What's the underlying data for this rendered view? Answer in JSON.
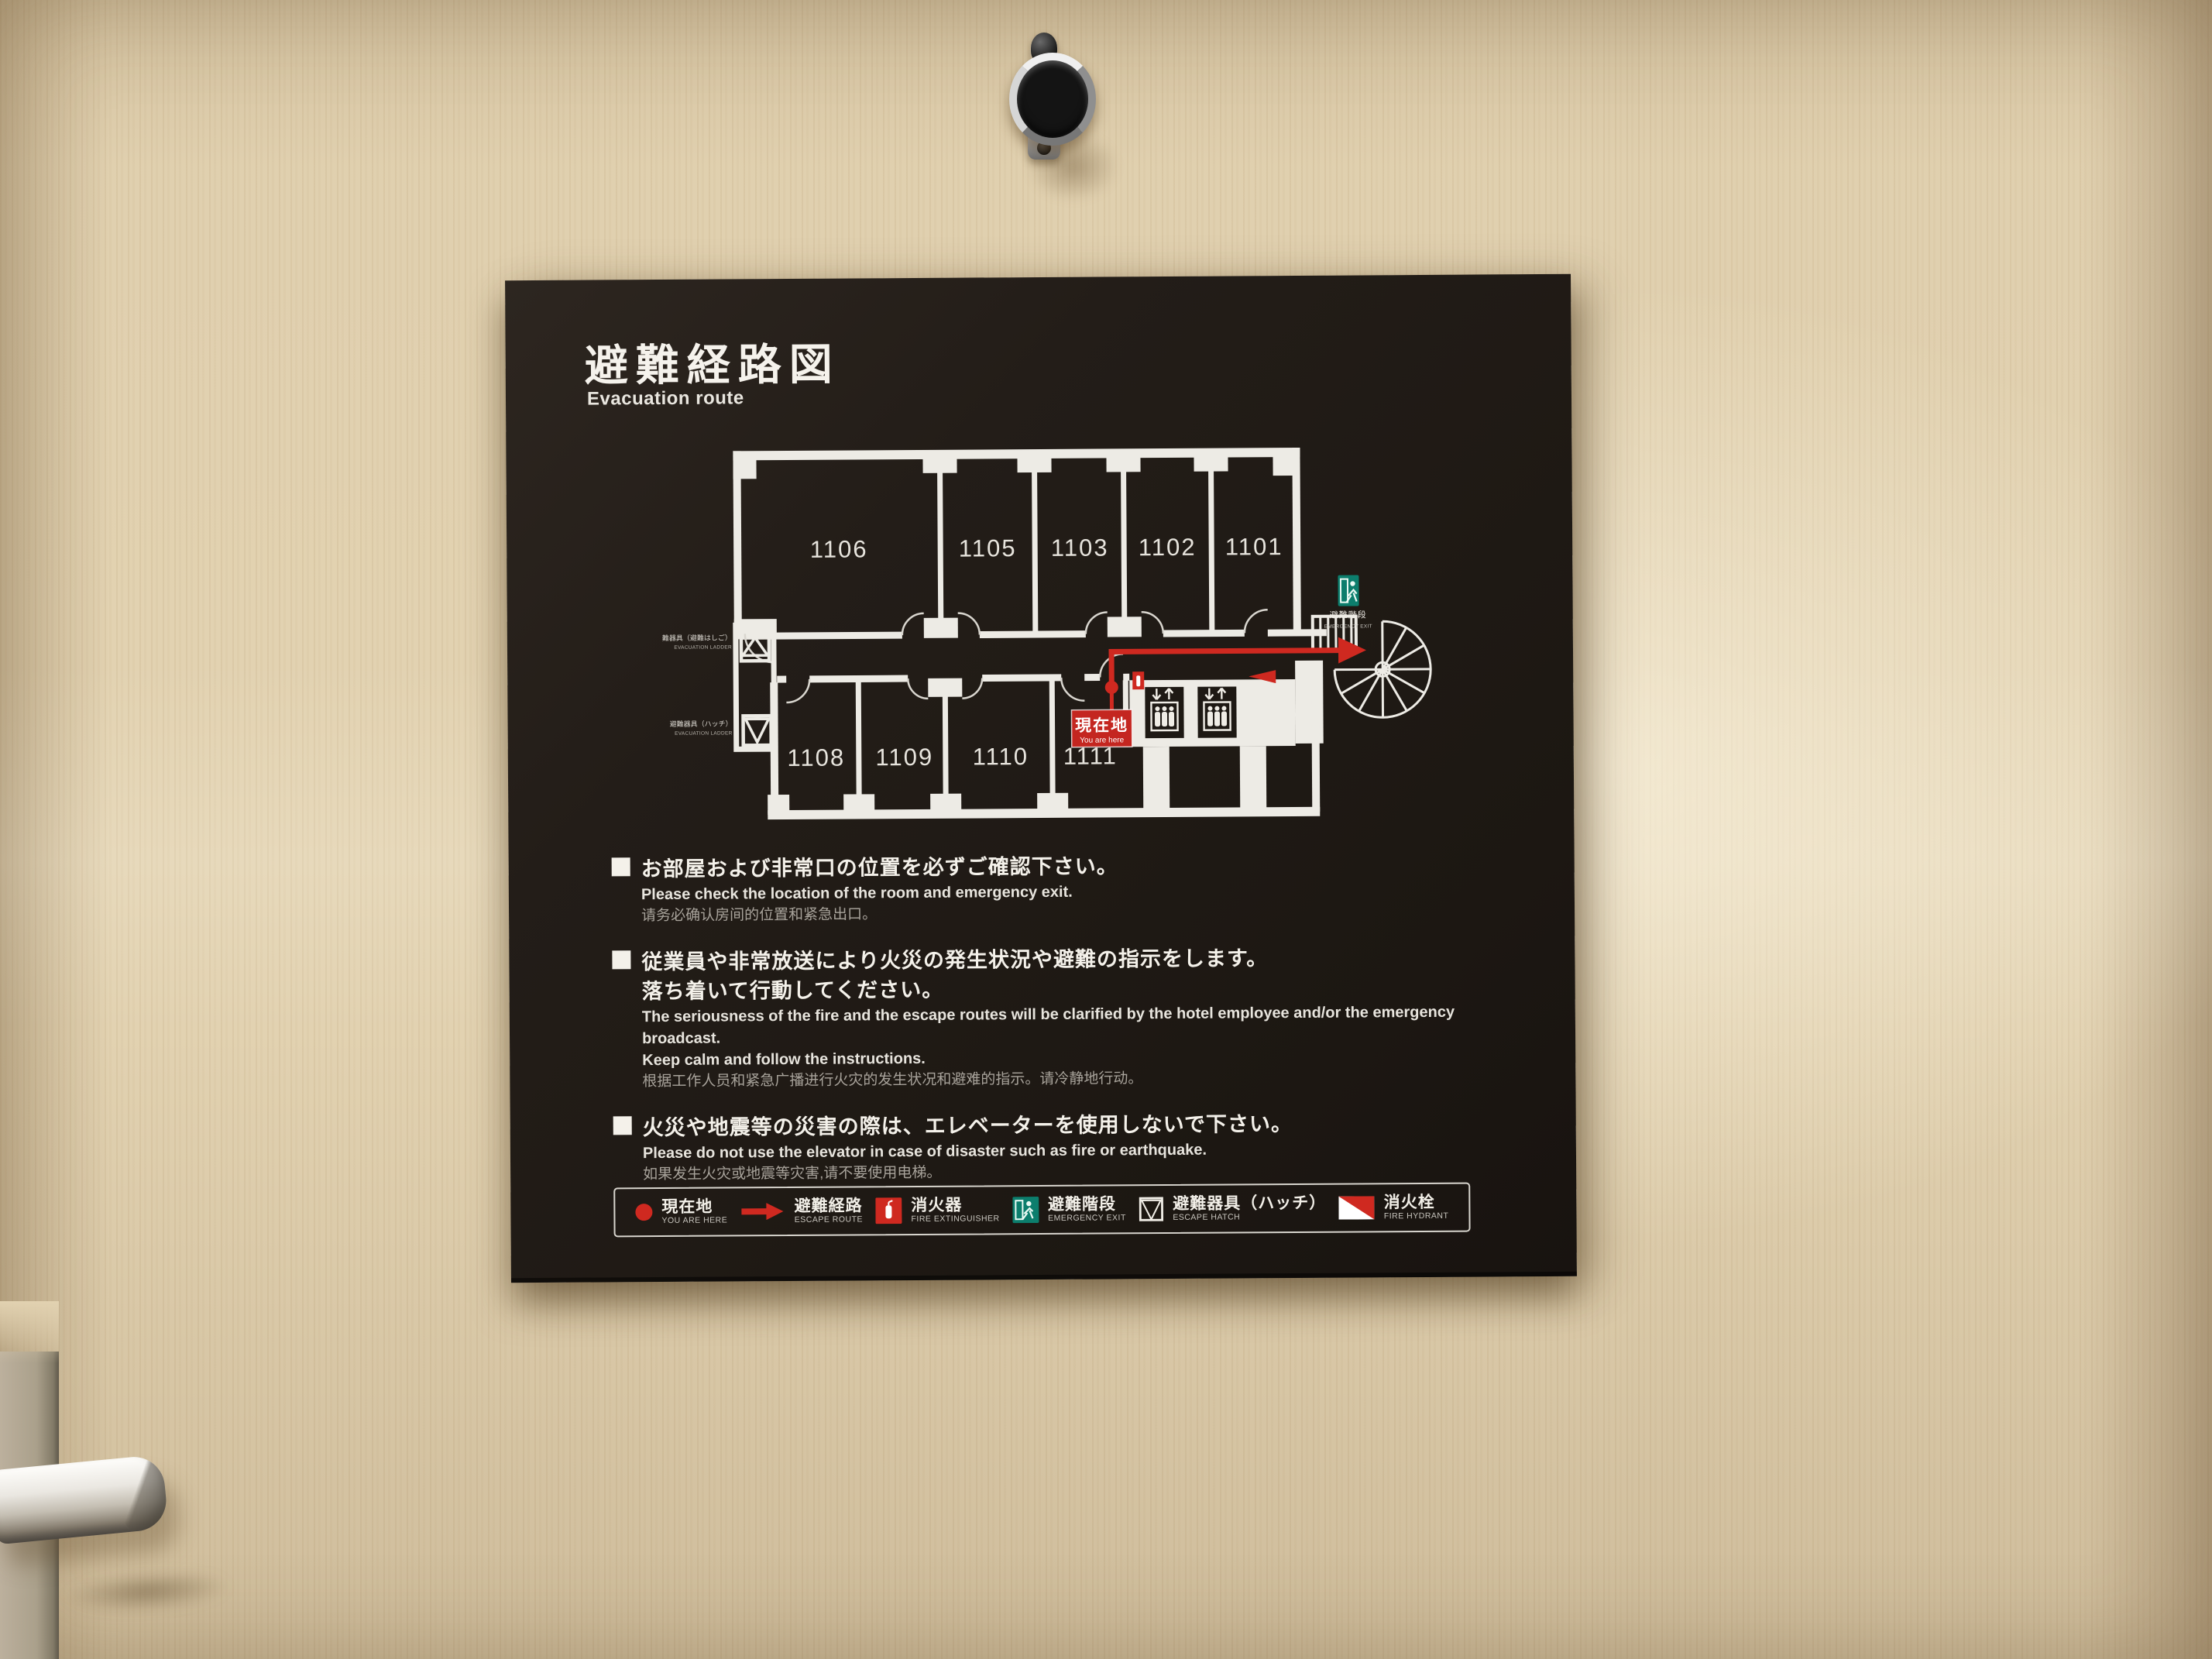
{
  "sign": {
    "title": {
      "ja": "避難経路図",
      "en": "Evacuation route"
    },
    "floorplan": {
      "rooms_top": [
        "1106",
        "1105",
        "1103",
        "1102",
        "1101"
      ],
      "rooms_bottom": [
        "1108",
        "1109",
        "1110",
        "1111"
      ],
      "you_are_here": {
        "ja": "現在地",
        "en": "You are here"
      },
      "stair_exit": {
        "ja": "避難階段",
        "en": "EMERGENCY EXIT"
      },
      "ladder_label": {
        "ja": "避難器具（避難はしご）",
        "en": "EVACUATION LADDER"
      },
      "hatch_label": {
        "ja": "避難器具（ハッチ）",
        "en": "EVACUATION LADDER"
      }
    },
    "notices": [
      {
        "ja": [
          "お部屋および非常口の位置を必ずご確認下さい。"
        ],
        "en": [
          "Please check the location of the room and emergency exit."
        ],
        "zh": [
          "请务必确认房间的位置和紧急出口。"
        ]
      },
      {
        "ja": [
          "従業員や非常放送により火災の発生状況や避難の指示をします。",
          "落ち着いて行動してください。"
        ],
        "en": [
          "The seriousness of the fire and the escape routes will be clarified by the hotel employee and/or the emergency broadcast.",
          "Keep calm and follow the instructions."
        ],
        "zh": [
          "根据工作人员和紧急广播进行火灾的发生状况和避难的指示。请冷静地行动。"
        ]
      },
      {
        "ja": [
          "火災や地震等の災害の際は、エレベーターを使用しないで下さい。"
        ],
        "en": [
          "Please do not use the elevator in case of disaster such as fire or earthquake."
        ],
        "zh": [
          "如果发生火灾或地震等灾害,请不要使用电梯。"
        ]
      }
    ],
    "legend": [
      {
        "icon": "you-are-here-dot",
        "ja": "現在地",
        "en": "YOU ARE HERE"
      },
      {
        "icon": "escape-route-arrow",
        "ja": "避難経路",
        "en": "ESCAPE ROUTE"
      },
      {
        "icon": "fire-extinguisher",
        "ja": "消火器",
        "en": "FIRE EXTINGUISHER"
      },
      {
        "icon": "emergency-exit",
        "ja": "避難階段",
        "en": "EMERGENCY EXIT"
      },
      {
        "icon": "escape-hatch",
        "ja": "避難器具（ハッチ）",
        "en": "ESCAPE HATCH"
      },
      {
        "icon": "fire-hydrant",
        "ja": "消火栓",
        "en": "FIRE HYDRANT"
      }
    ],
    "colors": {
      "accent_red": "#cf2920",
      "exit_green": "#0c7e6d",
      "sign_bg": "#1e1914"
    }
  }
}
